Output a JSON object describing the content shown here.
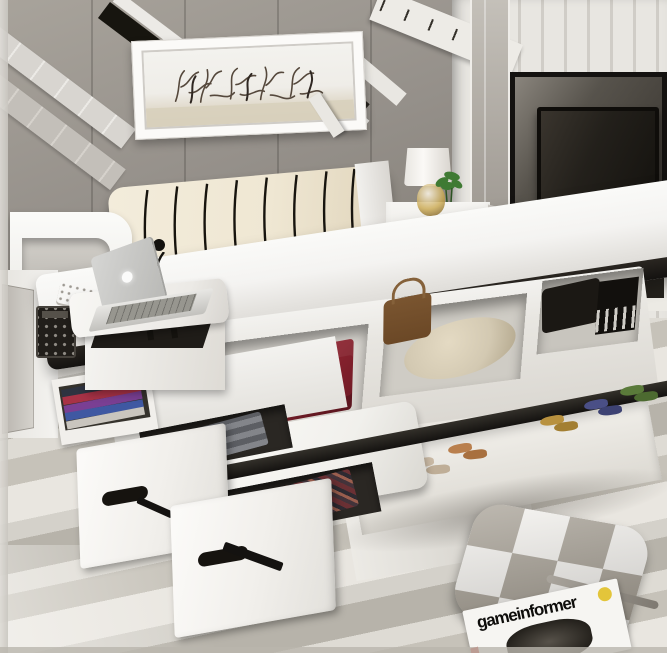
{
  "alt": "Photograph of a modern white multifunctional storage platform bed: lift-up mattress revealing storage compartments with a red suitcase, beige cushion, brown and black bags; cream tufted headboard with black piping; side unit with laptop on a swivel table, reading lamp and keypad safe; pull-out drawers with folded clothes; under-bed shoe rack; wall-mounted TV in a white paneled niche; framed twig artwork on a gray concrete wall; striped rug with a checkered floor pillow and a magazine",
  "magazine": {
    "title": "gameinformer"
  },
  "icons": {
    "laptop_logo": "apple-logo"
  },
  "objects": [
    "concrete-wall",
    "white-paneled-wardrobe",
    "tv",
    "framed-twig-artwork",
    "mirror-strip",
    "cream-headboard",
    "table-lamp",
    "potted-plant",
    "nightstand",
    "lifted-mattress",
    "storage-compartments",
    "red-suitcase",
    "beige-pillow",
    "brown-handbag",
    "black-bags",
    "bench-cushion",
    "storage-drawers",
    "folded-clothes",
    "magazine-shelf",
    "laptop",
    "swivel-table",
    "reading-lamp",
    "keypad-safe",
    "shoe-rack",
    "striped-rug",
    "checkered-floor-pillow",
    "magazine"
  ],
  "palette": {
    "wall_gray": "#95908a",
    "wall_gray_dark": "#7d786f",
    "panel_white": "#e8e6e1",
    "panel_groove": "#d0cdc7",
    "headboard_cream": "#efe7d3",
    "piping_black": "#17140e",
    "bed_white": "#f4f3f1",
    "trim_black": "#141210",
    "floor_light": "#e9e6e0",
    "floor_stripe": "#b7b3aa",
    "red_suitcase": "#8e2430",
    "brown_bag": "#6b4826",
    "beige_pillow": "#d3c9b2",
    "black_bag": "#1b1814",
    "tv_black": "#0f0d0a",
    "plant_green": "#3f7a33",
    "checker_gray": "#a29b8f",
    "magazine_yellow": "#e3c53a",
    "magazine_red": "#c23b2e"
  }
}
